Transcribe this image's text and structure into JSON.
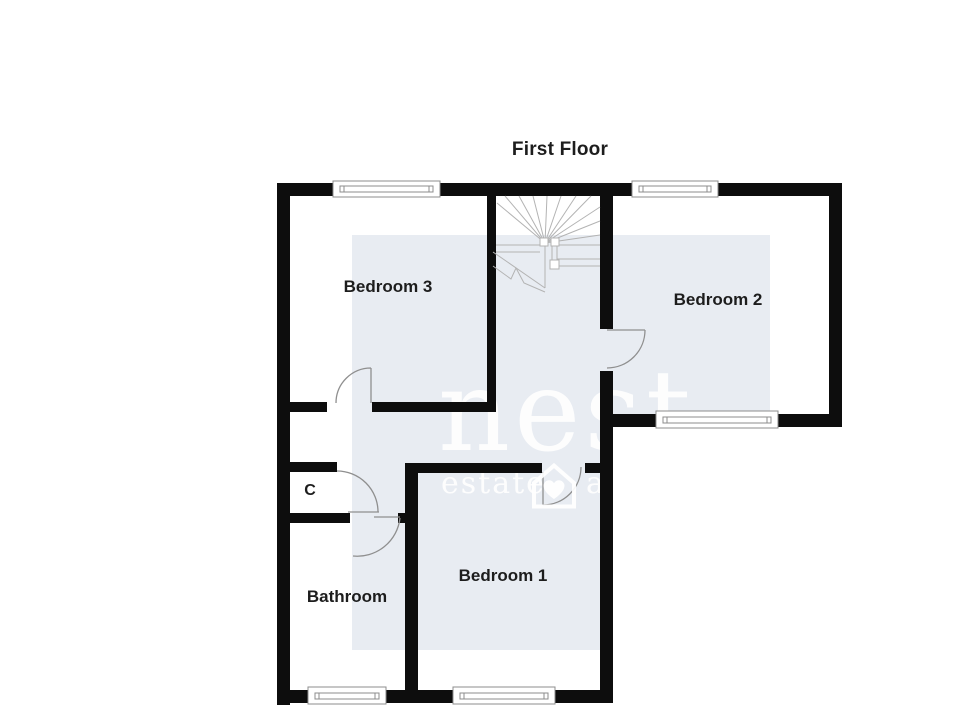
{
  "plan": {
    "title": "First Floor",
    "rooms": [
      {
        "id": "bedroom-3",
        "label": "Bedroom 3"
      },
      {
        "id": "bedroom-2",
        "label": "Bedroom 2"
      },
      {
        "id": "bedroom-1",
        "label": "Bedroom 1"
      },
      {
        "id": "bathroom",
        "label": "Bathroom"
      },
      {
        "id": "closet",
        "label": "C"
      }
    ]
  },
  "watermark": {
    "brand": "nest",
    "tagline_left": "estate",
    "tagline_right": "a",
    "icon": "house-heart-icon"
  },
  "colors": {
    "wall": "#0d0d0d",
    "panel": "#e8ecf2",
    "wm": "#ffffff",
    "door": "#8f8f8f",
    "stair": "#b3b3b3",
    "label": "#1d1d1d",
    "bg": "#ffffff",
    "winline": "#8c8c8c"
  }
}
